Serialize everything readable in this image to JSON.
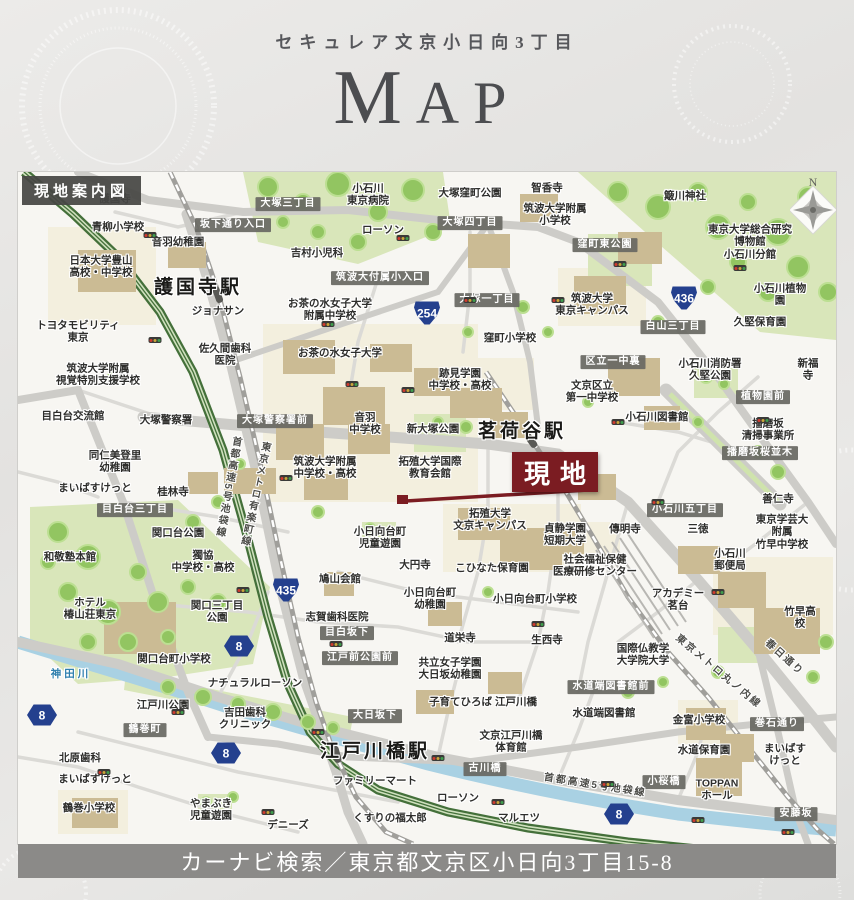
{
  "header": {
    "subtitle": "セキュレア文京小日向3丁目",
    "title": "MAP"
  },
  "map": {
    "corner_title": "現地案内図",
    "site_label": "現地",
    "compass_label": "N",
    "colors": {
      "site": "#7b1c22",
      "badge": "#24408e",
      "label_box": "#68685f",
      "highway": "#44703a",
      "water": "#a9d1e3",
      "park": "#d9e6ba",
      "building": "#cbbb94"
    },
    "labels": [
      {
        "t": "護国寺",
        "x": 97,
        "y": 27
      },
      {
        "t": "青柳小学校",
        "x": 100,
        "y": 55
      },
      {
        "t": "音羽幼稚園",
        "x": 160,
        "y": 70
      },
      {
        "t": "日本大学豊山\n高校・中学校",
        "x": 83,
        "y": 95
      },
      {
        "t": "護国寺駅",
        "x": 180,
        "y": 116,
        "type": "station"
      },
      {
        "t": "ジョナサン",
        "x": 200,
        "y": 139
      },
      {
        "t": "トヨタモビリティ\n東京",
        "x": 60,
        "y": 160
      },
      {
        "t": "佐久間歯科\n医院",
        "x": 207,
        "y": 183
      },
      {
        "t": "小石川\n東京病院",
        "x": 350,
        "y": 23
      },
      {
        "t": "大塚窪町公園",
        "x": 452,
        "y": 21
      },
      {
        "t": "智香寺",
        "x": 529,
        "y": 16
      },
      {
        "t": "筑波大学附属\n小学校",
        "x": 537,
        "y": 43
      },
      {
        "t": "ローソン",
        "x": 365,
        "y": 58
      },
      {
        "t": "吉村小児科",
        "x": 299,
        "y": 81
      },
      {
        "t": "簸川神社",
        "x": 667,
        "y": 24
      },
      {
        "t": "東京大学総合研究博物館\n小石川分館",
        "x": 732,
        "y": 70
      },
      {
        "t": "小石川植物園",
        "x": 762,
        "y": 123
      },
      {
        "t": "久堅保育園",
        "x": 742,
        "y": 150
      },
      {
        "t": "お茶の水女子大学\n附属中学校",
        "x": 312,
        "y": 138
      },
      {
        "t": "お茶の水女子大学",
        "x": 322,
        "y": 181
      },
      {
        "t": "筑波大学\n東京キャンパス",
        "x": 574,
        "y": 133
      },
      {
        "t": "窪町小学校",
        "x": 492,
        "y": 166
      },
      {
        "t": "跡見学園\n中学校・高校",
        "x": 442,
        "y": 208
      },
      {
        "t": "区立一中裏",
        "x": 595,
        "y": 190,
        "type": "box"
      },
      {
        "t": "文京区立\n第一中学校",
        "x": 574,
        "y": 220
      },
      {
        "t": "小石川消防署\n久堅公園",
        "x": 692,
        "y": 198
      },
      {
        "t": "新福寺",
        "x": 790,
        "y": 198
      },
      {
        "t": "白山三丁目",
        "x": 655,
        "y": 155,
        "type": "box"
      },
      {
        "t": "窪町東公園",
        "x": 587,
        "y": 73,
        "type": "box"
      },
      {
        "t": "大塚三丁目",
        "x": 270,
        "y": 32,
        "type": "box"
      },
      {
        "t": "坂下通り入口",
        "x": 215,
        "y": 53,
        "type": "box"
      },
      {
        "t": "大塚四丁目",
        "x": 452,
        "y": 51,
        "type": "box"
      },
      {
        "t": "大塚一丁目",
        "x": 469,
        "y": 128,
        "type": "box"
      },
      {
        "t": "筑波大付属小入口",
        "x": 362,
        "y": 106,
        "type": "box"
      },
      {
        "t": "筑波大学附属\n視覚特別支援学校",
        "x": 80,
        "y": 203
      },
      {
        "t": "目白台交流館",
        "x": 55,
        "y": 244
      },
      {
        "t": "大塚警察署",
        "x": 148,
        "y": 248
      },
      {
        "t": "大塚警察署前",
        "x": 257,
        "y": 249,
        "type": "box"
      },
      {
        "t": "音羽\n中学校",
        "x": 347,
        "y": 252
      },
      {
        "t": "新大塚公園",
        "x": 415,
        "y": 257
      },
      {
        "t": "茗荷谷駅",
        "x": 504,
        "y": 260,
        "type": "station"
      },
      {
        "t": "同仁美登里\n幼稚園",
        "x": 97,
        "y": 290
      },
      {
        "t": "まいばすけっと",
        "x": 77,
        "y": 316
      },
      {
        "t": "桂林寺",
        "x": 155,
        "y": 320
      },
      {
        "t": "目白台三丁目",
        "x": 117,
        "y": 338,
        "type": "box"
      },
      {
        "t": "筑波大学附属\n中学校・高校",
        "x": 307,
        "y": 296
      },
      {
        "t": "拓殖大学国際\n教育会館",
        "x": 412,
        "y": 296
      },
      {
        "t": "小石川図書館",
        "x": 639,
        "y": 245
      },
      {
        "t": "植物園前",
        "x": 745,
        "y": 225,
        "type": "box"
      },
      {
        "t": "播磨坂\n清掃事業所",
        "x": 750,
        "y": 258
      },
      {
        "t": "播磨坂桜並木",
        "x": 742,
        "y": 281,
        "type": "box"
      },
      {
        "t": "善仁寺",
        "x": 760,
        "y": 327
      },
      {
        "t": "小石川五丁目",
        "x": 667,
        "y": 338,
        "type": "box"
      },
      {
        "t": "東京学芸大附属\n竹早中学校",
        "x": 764,
        "y": 360
      },
      {
        "t": "傳明寺",
        "x": 607,
        "y": 357
      },
      {
        "t": "三徳",
        "x": 680,
        "y": 357
      },
      {
        "t": "小日向台町\n児童遊園",
        "x": 362,
        "y": 366
      },
      {
        "t": "拓殖大学\n文京キャンパス",
        "x": 472,
        "y": 348
      },
      {
        "t": "貞静学園\n短期大学",
        "x": 547,
        "y": 363
      },
      {
        "t": "社会福祉保健\n医療研修センター",
        "x": 577,
        "y": 394
      },
      {
        "t": "小石川\n郵便局",
        "x": 712,
        "y": 388
      },
      {
        "t": "大円寺",
        "x": 397,
        "y": 393
      },
      {
        "t": "こひなた保育園",
        "x": 474,
        "y": 396
      },
      {
        "t": "アカデミー\n茗台",
        "x": 660,
        "y": 428
      },
      {
        "t": "小日向台町\n幼稚園",
        "x": 412,
        "y": 427
      },
      {
        "t": "小日向台町小学校",
        "x": 517,
        "y": 427
      },
      {
        "t": "竹早高校",
        "x": 782,
        "y": 446
      },
      {
        "t": "関口台公園",
        "x": 160,
        "y": 361
      },
      {
        "t": "獨協\n中学校・高校",
        "x": 185,
        "y": 390
      },
      {
        "t": "関口三丁目\n公園",
        "x": 199,
        "y": 440
      },
      {
        "t": "鳩山会館",
        "x": 322,
        "y": 407
      },
      {
        "t": "志賀歯科医院",
        "x": 319,
        "y": 445
      },
      {
        "t": "目白坂下",
        "x": 329,
        "y": 461,
        "type": "box"
      },
      {
        "t": "道栄寺",
        "x": 442,
        "y": 466
      },
      {
        "t": "生西寺",
        "x": 529,
        "y": 468
      },
      {
        "t": "国際仏教学\n大学院大学",
        "x": 625,
        "y": 483
      },
      {
        "t": "和敬塾本館",
        "x": 52,
        "y": 385
      },
      {
        "t": "ホテル\n椿山荘東京",
        "x": 72,
        "y": 437
      },
      {
        "t": "関口台町小学校",
        "x": 156,
        "y": 487
      },
      {
        "t": "ナチュラルローソン",
        "x": 237,
        "y": 511
      },
      {
        "t": "江戸前公園前",
        "x": 342,
        "y": 486,
        "type": "box"
      },
      {
        "t": "共立女子学園\n大日坂幼稚園",
        "x": 432,
        "y": 497
      },
      {
        "t": "神田川",
        "x": 53,
        "y": 502,
        "type": "water"
      },
      {
        "t": "江戸川公園",
        "x": 145,
        "y": 533
      },
      {
        "t": "吉田歯科\nクリニック",
        "x": 227,
        "y": 547
      },
      {
        "t": "鶴巻町",
        "x": 127,
        "y": 558,
        "type": "box"
      },
      {
        "t": "大日坂下",
        "x": 357,
        "y": 544,
        "type": "box"
      },
      {
        "t": "子育てひろば 江戸川橋",
        "x": 465,
        "y": 530
      },
      {
        "t": "文京江戸川橋\n体育館",
        "x": 493,
        "y": 570
      },
      {
        "t": "江戸川橋駅",
        "x": 357,
        "y": 580,
        "type": "station"
      },
      {
        "t": "古川橋",
        "x": 467,
        "y": 597,
        "type": "box"
      },
      {
        "t": "水道端図書館前",
        "x": 593,
        "y": 515,
        "type": "box"
      },
      {
        "t": "水道端図書館",
        "x": 586,
        "y": 541
      },
      {
        "t": "金富小学校",
        "x": 681,
        "y": 548
      },
      {
        "t": "巻石通り",
        "x": 759,
        "y": 552,
        "type": "box"
      },
      {
        "t": "水道保育園",
        "x": 686,
        "y": 578
      },
      {
        "t": "まいばすけっと",
        "x": 767,
        "y": 583
      },
      {
        "t": "小桜橋",
        "x": 646,
        "y": 610,
        "type": "box"
      },
      {
        "t": "TOPPAN\nホール",
        "x": 699,
        "y": 618
      },
      {
        "t": "安藤坂",
        "x": 778,
        "y": 642,
        "type": "box"
      },
      {
        "t": "北原歯科",
        "x": 62,
        "y": 586
      },
      {
        "t": "まいばすけっと",
        "x": 77,
        "y": 607
      },
      {
        "t": "鶴巻小学校",
        "x": 71,
        "y": 636
      },
      {
        "t": "やまぶき\n児童遊園",
        "x": 193,
        "y": 638
      },
      {
        "t": "デニーズ",
        "x": 270,
        "y": 653
      },
      {
        "t": "ファミリーマート",
        "x": 357,
        "y": 609
      },
      {
        "t": "ローソン",
        "x": 440,
        "y": 626
      },
      {
        "t": "くすりの福太郎",
        "x": 372,
        "y": 646
      },
      {
        "t": "マルエツ",
        "x": 501,
        "y": 646
      },
      {
        "t": "首都高速5号池袋線",
        "x": 209,
        "y": 315,
        "vert": true,
        "rot": 10,
        "type": "line"
      },
      {
        "t": "東京メトロ有楽町線",
        "x": 236,
        "y": 322,
        "vert": true,
        "rot": 12,
        "type": "line"
      },
      {
        "t": "東京メトロ丸ノ内線",
        "x": 700,
        "y": 500,
        "rot": 40,
        "type": "line"
      },
      {
        "t": "春日通り",
        "x": 766,
        "y": 486,
        "rot": 42,
        "type": "line"
      },
      {
        "t": "首都高速5号池袋線",
        "x": 577,
        "y": 614,
        "rot": 9,
        "type": "line"
      }
    ],
    "badges": [
      {
        "n": "254",
        "x": 409,
        "y": 141,
        "shape": "shield"
      },
      {
        "n": "436",
        "x": 666,
        "y": 126,
        "shape": "shield"
      },
      {
        "n": "435",
        "x": 268,
        "y": 418,
        "shape": "shield"
      },
      {
        "n": "8",
        "x": 221,
        "y": 474,
        "shape": "hex"
      },
      {
        "n": "8",
        "x": 24,
        "y": 543,
        "shape": "hex"
      },
      {
        "n": "8",
        "x": 208,
        "y": 581,
        "shape": "hex"
      },
      {
        "n": "8",
        "x": 601,
        "y": 642,
        "shape": "hex"
      }
    ],
    "signals": [
      [
        132,
        63
      ],
      [
        385,
        66
      ],
      [
        540,
        128
      ],
      [
        602,
        92
      ],
      [
        722,
        96
      ],
      [
        137,
        168
      ],
      [
        334,
        212
      ],
      [
        390,
        218
      ],
      [
        600,
        250
      ],
      [
        310,
        152
      ],
      [
        268,
        306
      ],
      [
        225,
        418
      ],
      [
        318,
        472
      ],
      [
        520,
        452
      ],
      [
        640,
        330
      ],
      [
        745,
        248
      ],
      [
        700,
        420
      ],
      [
        420,
        586
      ],
      [
        300,
        560
      ],
      [
        160,
        540
      ],
      [
        250,
        640
      ],
      [
        480,
        630
      ],
      [
        590,
        612
      ],
      [
        680,
        648
      ],
      [
        770,
        660
      ],
      [
        86,
        600
      ],
      [
        452,
        128
      ]
    ]
  },
  "footer": {
    "navi_text": "カーナビ検索／東京都文京区小日向3丁目15-8"
  }
}
